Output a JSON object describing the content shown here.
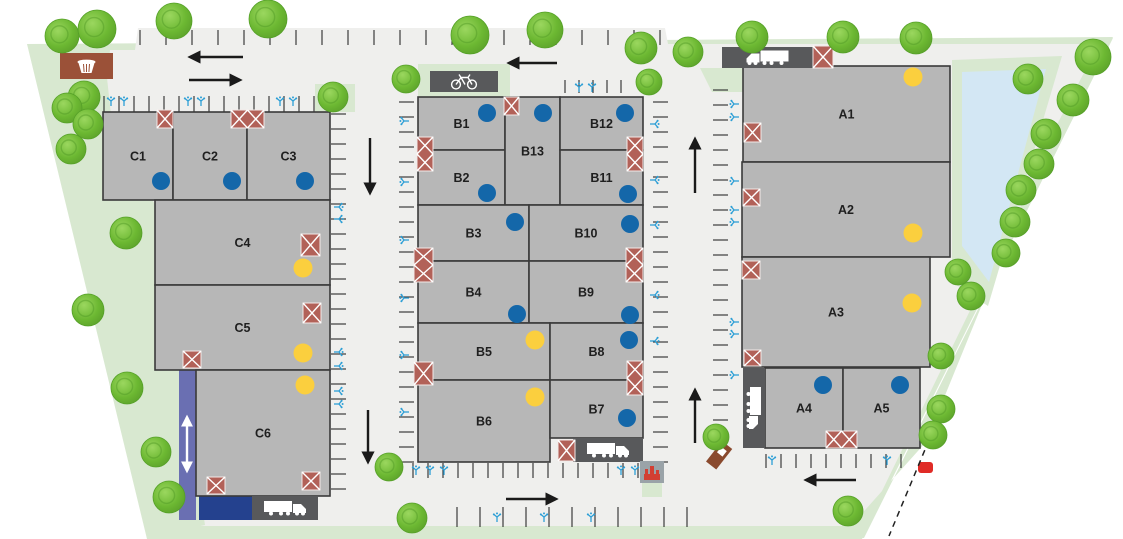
{
  "plan_title": "Business park site plan",
  "colors": {
    "white": "#ffffff",
    "green": "#d8e8d0",
    "paved": "#efefed",
    "building": "#b7b7b7",
    "buildingEdge": "#3a3a3a",
    "dock": "#58595b",
    "crosshatch": "#b26158",
    "blueDot": "#1467a9",
    "yellowDot": "#fbcf3e",
    "purple": "#6a6fb2",
    "darkBlue": "#24418e",
    "pond": "#d3e7f4",
    "ev": "#2d9fd6",
    "tick": "#2b2b2b",
    "arrow": "#1a1a1a",
    "brown": "#9b5138",
    "transformerBox": "#9aa3a8",
    "transformerIcon": "#d23f33",
    "red": "#e02b26",
    "treeEdge": "#55a028"
  },
  "areas": {
    "site": "27,44 1113,37 862,539 147,539",
    "paved": "104,50 135,50 138,28 665,28 668,44 1100,44 862,532 156,532",
    "leftWedge": "28,44 110,50 104,112 158,210 182,375 205,525 150,537",
    "rightBand": "1100,42 1113,38 864,538 840,538 926,442 1050,138",
    "pondPad": "952,60 1062,56 988,306 952,282",
    "pond": "962,72 1046,69 989,282 962,246",
    "wedges": [
      "700,68 743,68 743,92 712,92"
    ],
    "patches": [
      [
        315,
        84,
        40,
        28
      ],
      [
        642,
        482,
        20,
        15
      ],
      [
        168,
        526,
        695,
        12
      ]
    ],
    "bikePad": [
      418,
      64,
      92,
      34
    ]
  },
  "buildings": [
    {
      "label": "C1",
      "x": 103,
      "y": 112,
      "w": 70,
      "h": 88
    },
    {
      "label": "C2",
      "x": 173,
      "y": 112,
      "w": 74,
      "h": 88
    },
    {
      "label": "C3",
      "x": 247,
      "y": 112,
      "w": 83,
      "h": 88
    },
    {
      "label": "C4",
      "x": 155,
      "y": 200,
      "w": 175,
      "h": 85
    },
    {
      "label": "C5",
      "x": 155,
      "y": 285,
      "w": 175,
      "h": 85
    },
    {
      "label": "C6",
      "x": 196,
      "y": 370,
      "w": 134,
      "h": 126
    },
    {
      "label": "B1",
      "x": 418,
      "y": 97,
      "w": 87,
      "h": 53
    },
    {
      "label": "B2",
      "x": 418,
      "y": 150,
      "w": 87,
      "h": 55
    },
    {
      "label": "B13",
      "x": 505,
      "y": 97,
      "w": 55,
      "h": 108
    },
    {
      "label": "B12",
      "x": 560,
      "y": 97,
      "w": 83,
      "h": 53
    },
    {
      "label": "B11",
      "x": 560,
      "y": 150,
      "w": 83,
      "h": 55
    },
    {
      "label": "B3",
      "x": 418,
      "y": 205,
      "w": 111,
      "h": 56
    },
    {
      "label": "B10",
      "x": 529,
      "y": 205,
      "w": 114,
      "h": 56
    },
    {
      "label": "B4",
      "x": 418,
      "y": 261,
      "w": 111,
      "h": 62
    },
    {
      "label": "B9",
      "x": 529,
      "y": 261,
      "w": 114,
      "h": 62
    },
    {
      "label": "B5",
      "x": 418,
      "y": 323,
      "w": 132,
      "h": 57
    },
    {
      "label": "B8",
      "x": 550,
      "y": 323,
      "w": 93,
      "h": 57
    },
    {
      "label": "B6",
      "x": 418,
      "y": 380,
      "w": 132,
      "h": 82
    },
    {
      "label": "B7",
      "x": 550,
      "y": 380,
      "w": 93,
      "h": 58
    },
    {
      "label": "A1",
      "x": 743,
      "y": 66,
      "w": 207,
      "h": 96
    },
    {
      "label": "A2",
      "x": 742,
      "y": 162,
      "w": 208,
      "h": 95
    },
    {
      "label": "A3",
      "x": 742,
      "y": 257,
      "w": 188,
      "h": 110
    },
    {
      "label": "A4",
      "x": 765,
      "y": 368,
      "w": 78,
      "h": 80
    },
    {
      "label": "A5",
      "x": 843,
      "y": 368,
      "w": 77,
      "h": 80
    }
  ],
  "dots": [
    {
      "x": 161,
      "y": 181,
      "c": "blue"
    },
    {
      "x": 232,
      "y": 181,
      "c": "blue"
    },
    {
      "x": 305,
      "y": 181,
      "c": "blue"
    },
    {
      "x": 303,
      "y": 268,
      "c": "yellow"
    },
    {
      "x": 303,
      "y": 353,
      "c": "yellow"
    },
    {
      "x": 305,
      "y": 385,
      "c": "yellow"
    },
    {
      "x": 487,
      "y": 113,
      "c": "blue"
    },
    {
      "x": 543,
      "y": 113,
      "c": "blue"
    },
    {
      "x": 625,
      "y": 113,
      "c": "blue"
    },
    {
      "x": 487,
      "y": 193,
      "c": "blue"
    },
    {
      "x": 628,
      "y": 194,
      "c": "blue"
    },
    {
      "x": 515,
      "y": 222,
      "c": "blue"
    },
    {
      "x": 630,
      "y": 224,
      "c": "blue"
    },
    {
      "x": 517,
      "y": 314,
      "c": "blue"
    },
    {
      "x": 630,
      "y": 315,
      "c": "blue"
    },
    {
      "x": 535,
      "y": 340,
      "c": "yellow"
    },
    {
      "x": 629,
      "y": 340,
      "c": "blue"
    },
    {
      "x": 535,
      "y": 397,
      "c": "yellow"
    },
    {
      "x": 627,
      "y": 418,
      "c": "blue"
    },
    {
      "x": 913,
      "y": 77,
      "c": "yellow"
    },
    {
      "x": 913,
      "y": 233,
      "c": "yellow"
    },
    {
      "x": 912,
      "y": 303,
      "c": "yellow"
    },
    {
      "x": 823,
      "y": 385,
      "c": "blue"
    },
    {
      "x": 900,
      "y": 385,
      "c": "blue"
    }
  ],
  "crosshatches": [
    [
      157,
      110,
      16,
      18,
      1,
      1
    ],
    [
      231,
      110,
      33,
      18,
      2,
      1
    ],
    [
      301,
      234,
      19,
      22,
      1,
      1
    ],
    [
      303,
      303,
      18,
      20,
      1,
      1
    ],
    [
      183,
      351,
      18,
      17,
      1,
      1
    ],
    [
      207,
      477,
      18,
      17,
      1,
      1
    ],
    [
      302,
      472,
      18,
      18,
      1,
      1
    ],
    [
      504,
      97,
      15,
      18,
      1,
      1
    ],
    [
      417,
      137,
      16,
      34,
      1,
      2
    ],
    [
      627,
      137,
      16,
      34,
      1,
      2
    ],
    [
      414,
      248,
      19,
      34,
      1,
      2
    ],
    [
      626,
      248,
      17,
      34,
      1,
      2
    ],
    [
      414,
      362,
      19,
      23,
      1,
      1
    ],
    [
      627,
      361,
      16,
      34,
      1,
      2
    ],
    [
      558,
      440,
      17,
      21,
      1,
      1
    ],
    [
      813,
      46,
      20,
      22,
      1,
      1
    ],
    [
      744,
      123,
      17,
      19,
      1,
      1
    ],
    [
      743,
      189,
      17,
      17,
      1,
      1
    ],
    [
      742,
      261,
      18,
      18,
      1,
      1
    ],
    [
      744,
      350,
      17,
      16,
      1,
      1
    ],
    [
      826,
      431,
      31,
      17,
      2,
      1
    ]
  ],
  "docks": [
    {
      "x": 722,
      "y": 47,
      "w": 91,
      "h": 21,
      "dir": "left"
    },
    {
      "x": 573,
      "y": 438,
      "w": 70,
      "h": 24,
      "dir": "right"
    },
    {
      "x": 252,
      "y": 496,
      "w": 66,
      "h": 24,
      "dir": "right"
    },
    {
      "x": 743,
      "y": 368,
      "w": 22,
      "h": 80,
      "dir": "down"
    }
  ],
  "bikeDock": [
    430,
    71,
    68,
    21
  ],
  "purpleStrip": [
    179,
    368,
    17,
    152
  ],
  "blueStructure": [
    199,
    496,
    53,
    24
  ],
  "twoWayArrow": {
    "x": 187,
    "y1": 417,
    "y2": 471
  },
  "parkingRows": [
    {
      "x": 140,
      "y": 30,
      "dir": "h",
      "count": 21,
      "spacing": 26,
      "len": 15
    },
    {
      "x": 104,
      "y": 96,
      "dir": "h",
      "count": 16,
      "spacing": 15,
      "len": 16
    },
    {
      "x": 565,
      "y": 80,
      "dir": "h",
      "count": 5,
      "spacing": 14,
      "len": 13
    },
    {
      "x": 331,
      "y": 114,
      "dir": "v",
      "count": 26,
      "spacing": 15,
      "len": 15
    },
    {
      "x": 399,
      "y": 102,
      "dir": "v",
      "count": 25,
      "spacing": 15,
      "len": 15
    },
    {
      "x": 653,
      "y": 102,
      "dir": "v",
      "count": 25,
      "spacing": 15,
      "len": 15
    },
    {
      "x": 713,
      "y": 90,
      "dir": "v",
      "count": 24,
      "spacing": 15,
      "len": 15
    },
    {
      "x": 413,
      "y": 463,
      "dir": "h",
      "count": 17,
      "spacing": 15,
      "len": 15
    },
    {
      "x": 766,
      "y": 454,
      "dir": "h",
      "count": 10,
      "spacing": 15,
      "len": 14
    },
    {
      "x": 457,
      "y": 507,
      "dir": "h",
      "count": 11,
      "spacing": 23,
      "len": 20
    }
  ],
  "evIcons": [
    [
      111,
      102,
      0
    ],
    [
      124,
      102,
      0
    ],
    [
      188,
      102,
      0
    ],
    [
      201,
      102,
      0
    ],
    [
      280,
      102,
      0
    ],
    [
      293,
      102,
      0
    ],
    [
      579,
      88,
      0
    ],
    [
      592,
      88,
      0
    ],
    [
      338,
      207,
      90
    ],
    [
      338,
      219,
      90
    ],
    [
      338,
      352,
      90
    ],
    [
      338,
      366,
      90
    ],
    [
      338,
      391,
      90
    ],
    [
      338,
      404,
      90
    ],
    [
      405,
      121,
      270
    ],
    [
      405,
      182,
      270
    ],
    [
      405,
      240,
      270
    ],
    [
      405,
      298,
      270
    ],
    [
      405,
      355,
      270
    ],
    [
      405,
      412,
      270
    ],
    [
      654,
      124,
      90
    ],
    [
      654,
      180,
      90
    ],
    [
      654,
      225,
      90
    ],
    [
      654,
      295,
      90
    ],
    [
      654,
      341,
      90
    ],
    [
      735,
      104,
      270
    ],
    [
      735,
      117,
      270
    ],
    [
      735,
      181,
      270
    ],
    [
      735,
      210,
      270
    ],
    [
      735,
      222,
      270
    ],
    [
      735,
      322,
      270
    ],
    [
      735,
      334,
      270
    ],
    [
      735,
      375,
      270
    ],
    [
      416,
      471,
      0
    ],
    [
      430,
      471,
      0
    ],
    [
      444,
      471,
      0
    ],
    [
      621,
      471,
      0
    ],
    [
      635,
      471,
      0
    ],
    [
      497,
      518,
      0
    ],
    [
      544,
      518,
      0
    ],
    [
      591,
      518,
      0
    ],
    [
      772,
      461,
      0
    ],
    [
      887,
      461,
      0
    ]
  ],
  "arrows": [
    [
      243,
      57,
      190,
      57
    ],
    [
      189,
      80,
      240,
      80
    ],
    [
      557,
      63,
      509,
      63
    ],
    [
      370,
      138,
      370,
      193
    ],
    [
      368,
      410,
      368,
      462
    ],
    [
      695,
      193,
      695,
      139
    ],
    [
      695,
      443,
      695,
      390
    ],
    [
      506,
      499,
      556,
      499
    ],
    [
      856,
      480,
      806,
      480
    ]
  ],
  "misc": {
    "brownBox": [
      60,
      53,
      53,
      26
    ],
    "transformer": [
      640,
      461,
      24,
      22
    ],
    "sign": {
      "x": 722,
      "y": 441,
      "w": 13,
      "h": 26,
      "rot": 38
    },
    "redCar": [
      918,
      462,
      15,
      11
    ],
    "dashedBoundary": [
      929,
      440,
      889,
      536
    ]
  },
  "trees": [
    [
      62,
      36,
      17
    ],
    [
      97,
      29,
      19
    ],
    [
      174,
      21,
      18
    ],
    [
      268,
      19,
      19
    ],
    [
      84,
      97,
      16
    ],
    [
      67,
      108,
      15
    ],
    [
      88,
      124,
      15
    ],
    [
      71,
      149,
      15
    ],
    [
      126,
      233,
      16
    ],
    [
      88,
      310,
      16
    ],
    [
      127,
      388,
      16
    ],
    [
      156,
      452,
      15
    ],
    [
      169,
      497,
      16
    ],
    [
      333,
      97,
      15
    ],
    [
      406,
      79,
      14
    ],
    [
      470,
      35,
      19
    ],
    [
      545,
      30,
      18
    ],
    [
      641,
      48,
      16
    ],
    [
      688,
      52,
      15
    ],
    [
      649,
      82,
      13
    ],
    [
      752,
      37,
      16
    ],
    [
      843,
      37,
      16
    ],
    [
      916,
      38,
      16
    ],
    [
      1093,
      57,
      18
    ],
    [
      1028,
      79,
      15
    ],
    [
      1073,
      100,
      16
    ],
    [
      1046,
      134,
      15
    ],
    [
      1039,
      164,
      15
    ],
    [
      1021,
      190,
      15
    ],
    [
      1015,
      222,
      15
    ],
    [
      1006,
      253,
      14
    ],
    [
      958,
      272,
      13
    ],
    [
      971,
      296,
      14
    ],
    [
      941,
      356,
      13
    ],
    [
      941,
      409,
      14
    ],
    [
      933,
      435,
      14
    ],
    [
      716,
      437,
      13
    ],
    [
      389,
      467,
      14
    ],
    [
      412,
      518,
      15
    ],
    [
      848,
      511,
      15
    ]
  ]
}
